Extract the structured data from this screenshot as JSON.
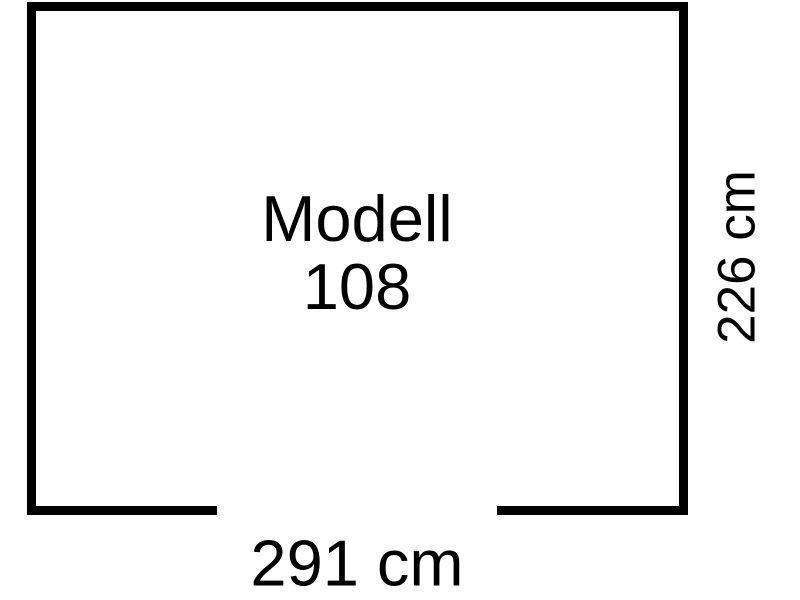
{
  "page": {
    "background_color": "#ffffff"
  },
  "floorplan": {
    "outline_color": "#000000",
    "model": {
      "line1": "Modell",
      "line2": "108"
    },
    "dimensions": {
      "width": "291 cm",
      "depth": "226 cm"
    }
  }
}
